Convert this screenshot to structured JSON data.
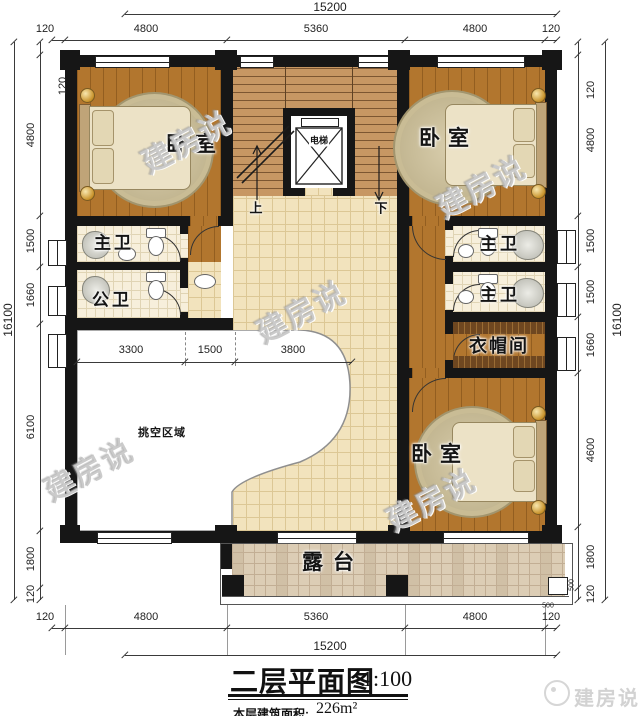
{
  "title_block": {
    "title": "二层平面图",
    "scale": "1:100",
    "area_label": "本层建筑面积:",
    "area_value": "226m²"
  },
  "brand": {
    "logo_text": "建房说"
  },
  "watermark": {
    "text": "建房说"
  },
  "rooms": {
    "bedroom_tl": "卧室",
    "bedroom_tr": "卧室",
    "bedroom_br": "卧室",
    "master_bath_left": "主卫",
    "public_bath": "公卫",
    "master_bath_r1": "主卫",
    "master_bath_r2": "主卫",
    "cloakroom": "衣帽间",
    "elevator": "电梯",
    "terrace": "露台",
    "void_area": "挑空区域",
    "stair_up": "上",
    "stair_down": "下"
  },
  "dimensions": {
    "top": {
      "total": "15200",
      "segments": [
        "120",
        "4800",
        "5360",
        "4800",
        "120"
      ]
    },
    "bottom": {
      "total": "15200",
      "segments": [
        "120",
        "4800",
        "5360",
        "4800",
        "120"
      ]
    },
    "left": {
      "total": "16100",
      "segments": [
        "120",
        "4800",
        "1500",
        "1660",
        "6100",
        "1800",
        "120"
      ]
    },
    "right": {
      "total": "16100",
      "segments": [
        "120",
        "4800",
        "1500",
        "1500",
        "1660",
        "4600",
        "1800",
        "120"
      ]
    },
    "interior": [
      "3300",
      "1500",
      "3800"
    ],
    "small": [
      "500",
      "500"
    ]
  },
  "colors": {
    "wall": "#161616",
    "wood_floor": "#b2762e",
    "hall_tile": "#f2e3bd",
    "bath_tile": "#f7efdb",
    "terrace_tile": "#dccdb5",
    "stair_floor": "#c79763"
  }
}
